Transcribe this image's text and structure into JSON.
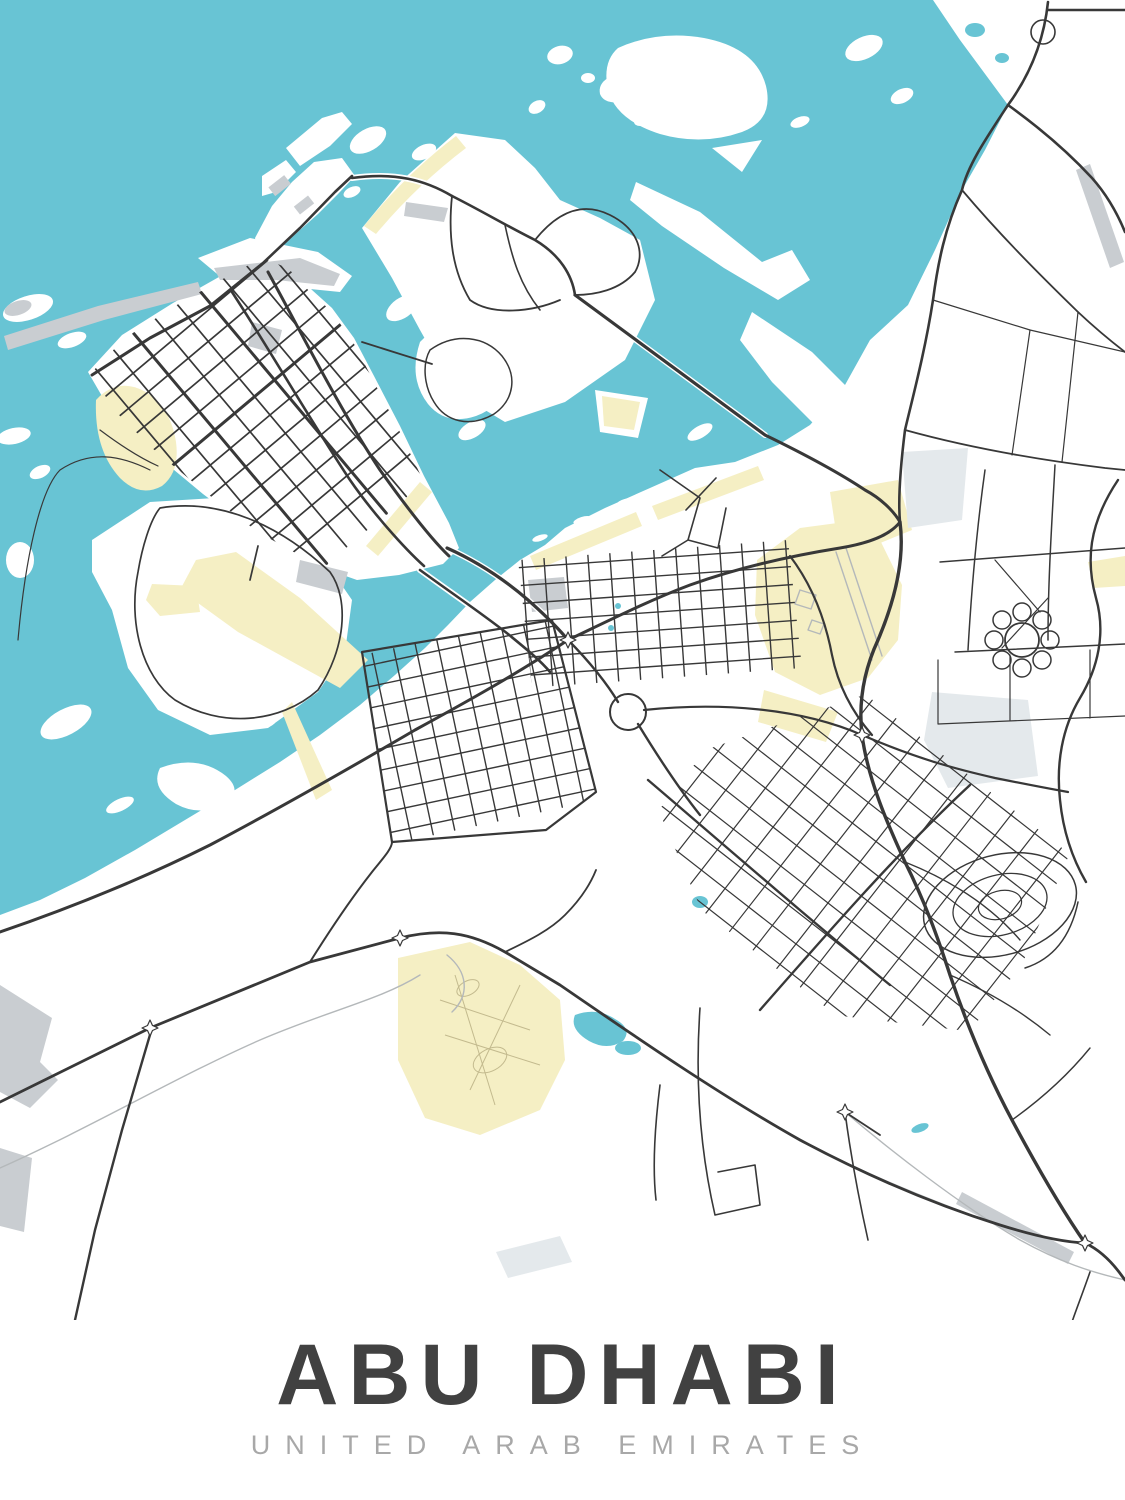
{
  "poster": {
    "title": "ABU DHABI",
    "subtitle": "UNITED ARAB EMIRATES"
  },
  "map": {
    "kind": "minimalist city street map poster",
    "colors": {
      "water": "#68c4d4",
      "land": "#ffffff",
      "park": "#f5efc4",
      "park_line": "#c3ba8e",
      "urban_gray": "#c9cdd1",
      "pale_zone": "#e4e9ec",
      "road": "#383838",
      "road_light": "#b4b8ba",
      "runway_gray": "#c8c8c8",
      "title": "#414141",
      "subtitle": "#a8a8a8"
    }
  }
}
